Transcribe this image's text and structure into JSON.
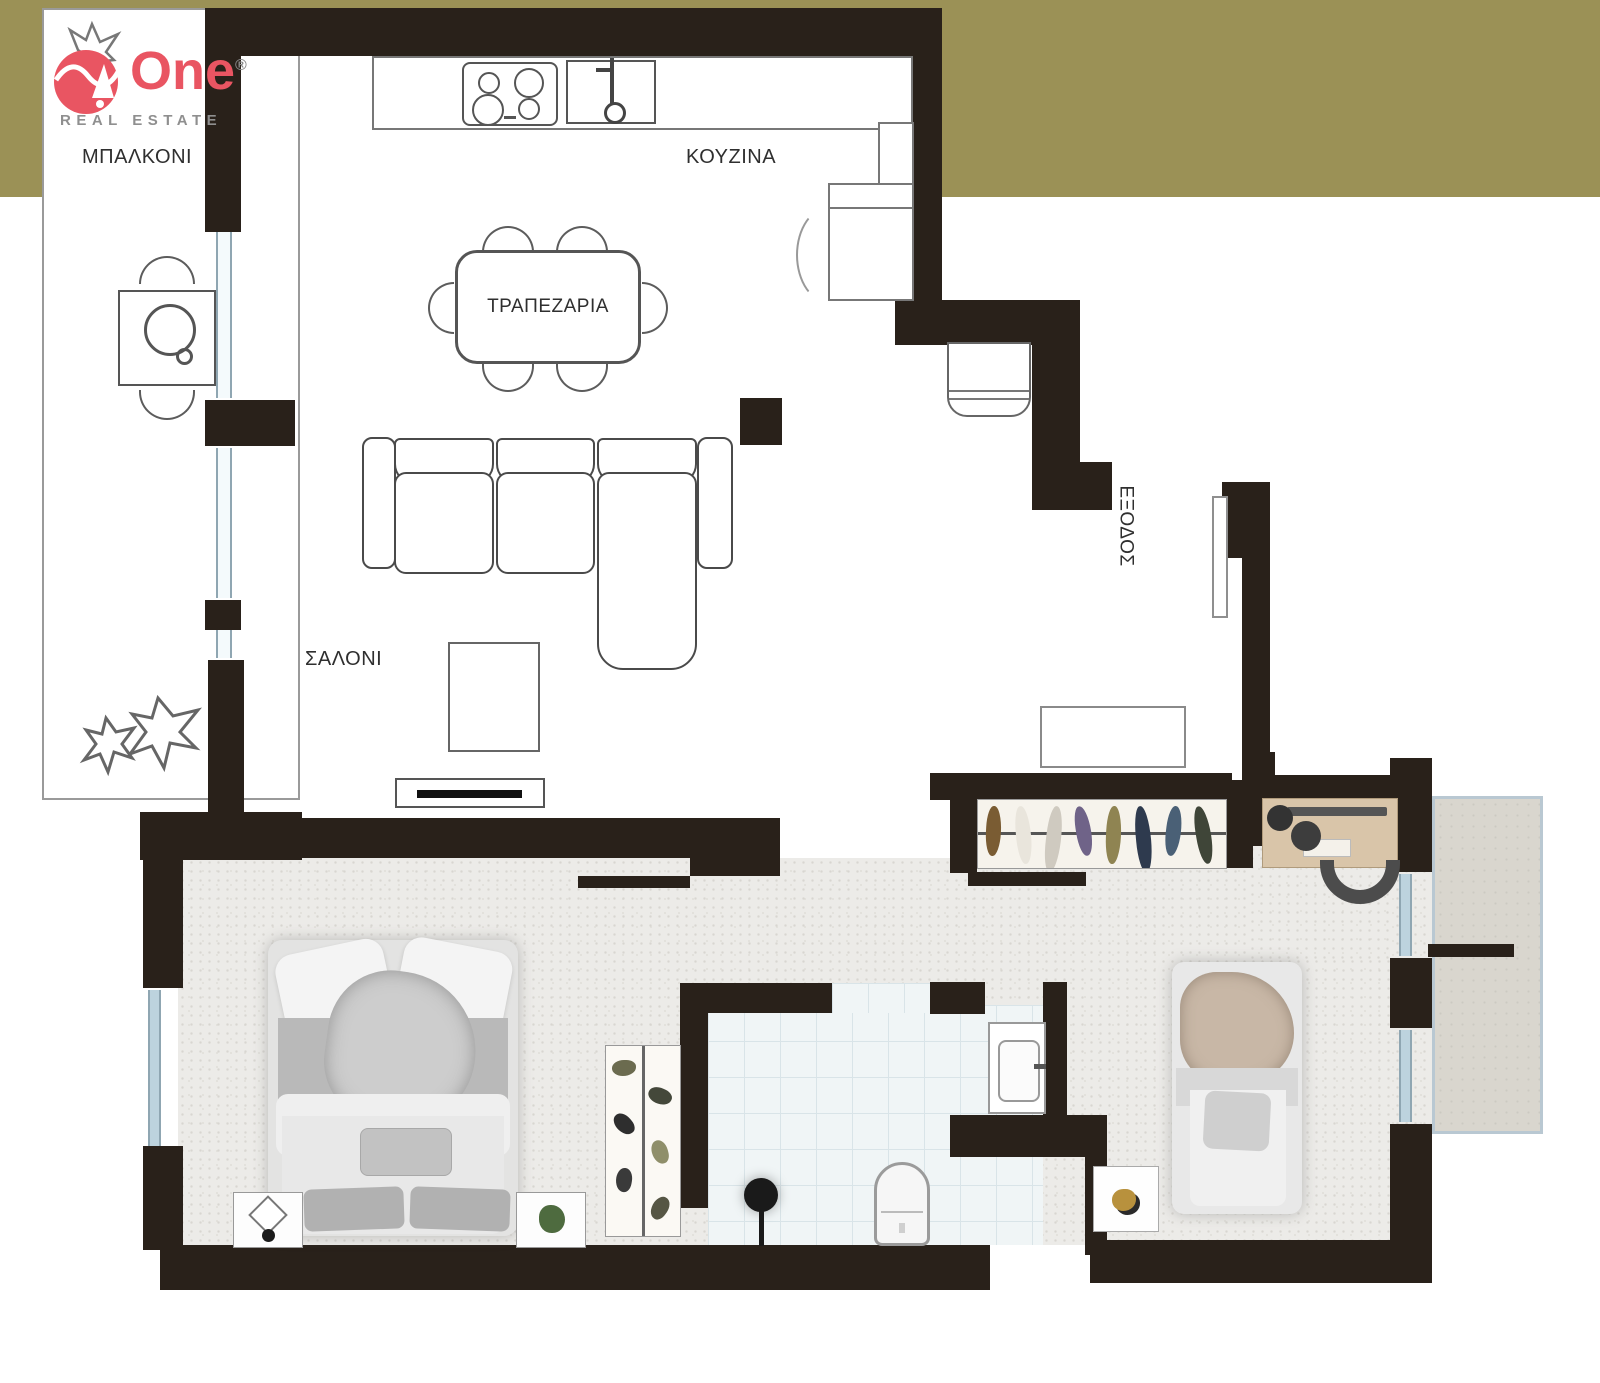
{
  "brand": {
    "name": "One",
    "registered_mark": "®",
    "tagline": "REAL ESTATE"
  },
  "rooms": {
    "balcony": "ΜΠΑΛΚΟΝΙ",
    "kitchen": "ΚΟΥΖΙΝΑ",
    "dining": "ΤΡΑΠΕΖΑΡΙΑ",
    "living": "ΣΑΛΟΝΙ",
    "exit": "ΕΞΟΔΟΣ"
  },
  "colors": {
    "band_olive": "#9b9156",
    "wall_black": "#29211a",
    "brand_red": "#e95562",
    "floor_gray": "#ecebe8",
    "tile_fill": "#f0f5f6",
    "tile_line": "#d9e4e8",
    "window_blue": "#bdd3de",
    "desk_wood": "#d9c5a9",
    "terrace_fill": "#d9d6ce",
    "terrace_border": "#b9c8d2"
  },
  "closet_colors": [
    "#7a5c33",
    "#e9e5dc",
    "#cfcac0",
    "#6f6388",
    "#8f8452",
    "#2e3a4e",
    "#4a6076",
    "#3f4538"
  ],
  "wardrobe_colors": [
    "#6b6b4f",
    "#44483a",
    "#2e2e2e",
    "#8f8f6a",
    "#3a3a3a",
    "#565644"
  ]
}
